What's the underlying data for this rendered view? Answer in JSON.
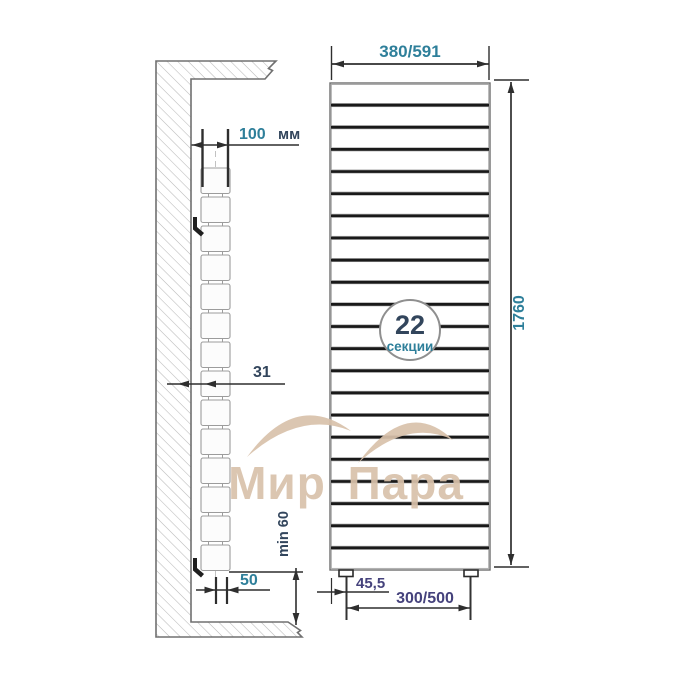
{
  "watermark": {
    "text": "Мир Пара"
  },
  "side_view": {
    "wall_offset": {
      "value": "100",
      "unit": "мм"
    },
    "depth_dim": "31",
    "bottom_dim": "50",
    "floor_clearance_dim": "min 60"
  },
  "front_view": {
    "width_dim": "380/591",
    "height_dim": "1760",
    "badge": {
      "count": "22",
      "label": "секции"
    },
    "foot_offset_dim": "45,5",
    "foot_spacing_dim": "300/500"
  },
  "drawing": {
    "front_sections": 22,
    "side_blocks": 14
  },
  "colors": {
    "dimension_teal": "#2e7f9a",
    "dimension_slate": "#32455c",
    "dimension_indigo": "#45427c",
    "watermark_beige": "#d9c2ab",
    "line_dark": "#2e2e2e"
  }
}
